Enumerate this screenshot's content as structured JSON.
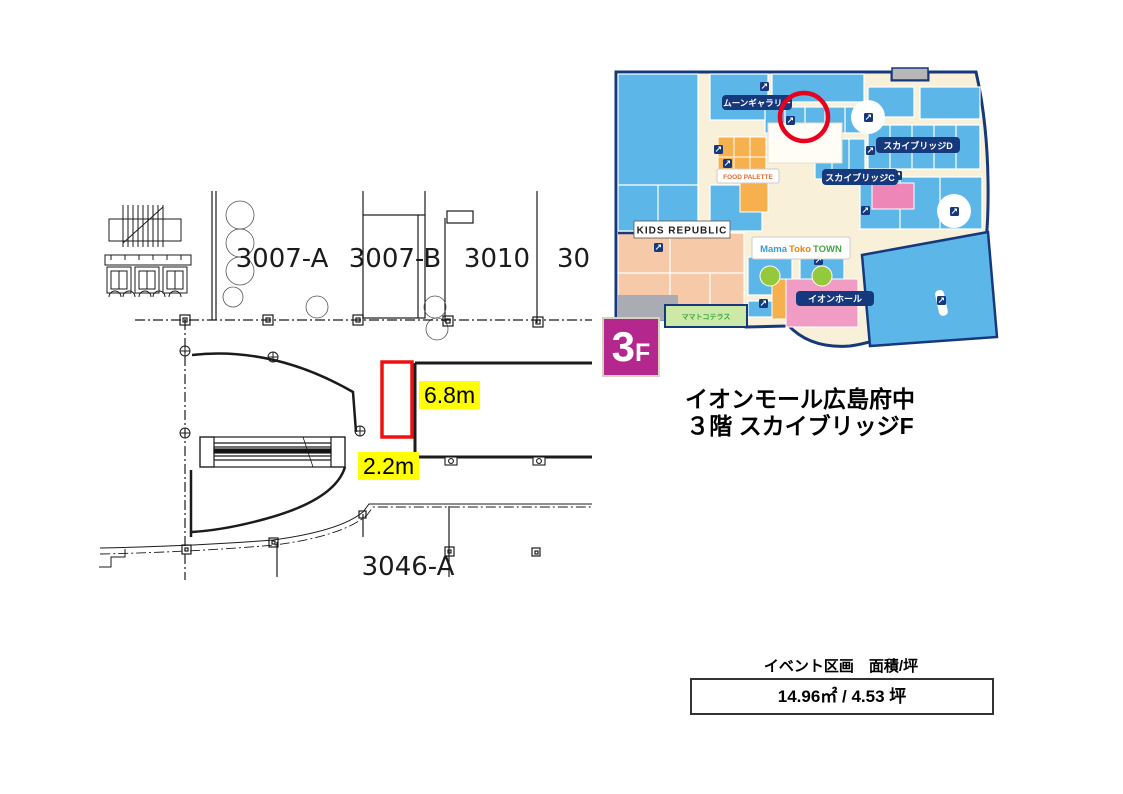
{
  "floorplan": {
    "rooms": [
      "3007-A",
      "3007-B",
      "3010",
      "30",
      "3046-A"
    ],
    "dims": {
      "height": "6.8m",
      "width": "2.2m"
    },
    "event_marker_color": "#ee1111",
    "highlight_color": "#ffff00"
  },
  "map": {
    "labels": {
      "moon_gallery": "ムーンギャラリー",
      "skybridge_d": "スカイブリッジD",
      "skybridge_c": "スカイブリッジC",
      "kids_republic": "KIDS REPUBLIC",
      "aeon_hall": "イオンホール",
      "food_palette": "FOOD PALETTE",
      "terrace": "ママトコテラス",
      "mamatoko": {
        "p1": "Mama",
        "p2": "Toko",
        "p3": "TOWN"
      }
    },
    "floor_badge": {
      "number": "3",
      "suffix": "F"
    },
    "colors": {
      "store_blue": "#5db6e8",
      "walkway_cream": "#f8f0d8",
      "outline_navy": "#16387c",
      "kids_salmon": "#f6c9a8",
      "foodcourt_orange": "#f6b04e",
      "hall_pink": "#f09cc4",
      "tree_green": "#95c93d",
      "annotation_red": "#e8001d",
      "floor_magenta": "#b4278d"
    }
  },
  "location": {
    "line1": "イオンモール広島府中",
    "line2": "３階 スカイブリッジF"
  },
  "area_table": {
    "header": "イベント区画　面積/坪",
    "value": "14.96㎡ / 4.53 坪"
  }
}
